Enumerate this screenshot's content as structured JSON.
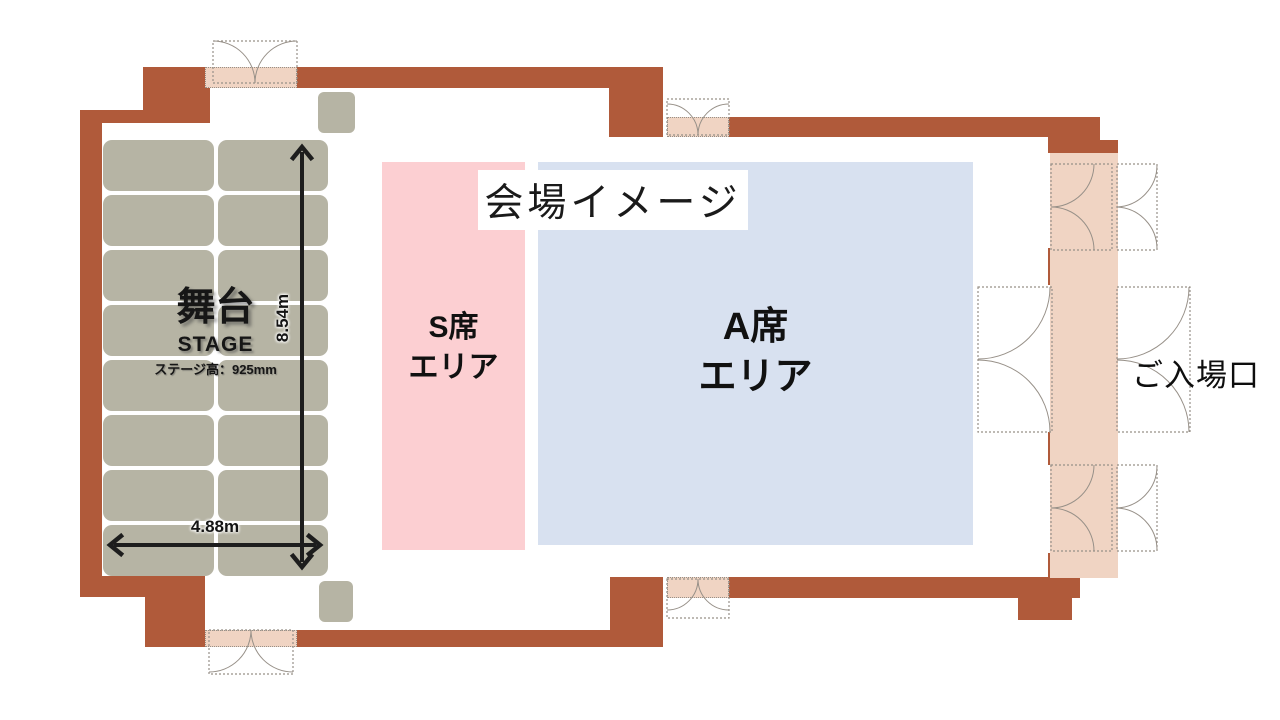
{
  "title": "会場イメージ",
  "stage": {
    "name_ja": "舞台",
    "name_en": "STAGE",
    "height_note": "ステージ高：925mm",
    "width_label": "4.88m",
    "depth_label": "8.54m",
    "grid_rows": 8,
    "grid_cols": 2
  },
  "areas": {
    "s_seat": {
      "line1": "S席",
      "line2": "エリア"
    },
    "a_seat": {
      "line1": "A席",
      "line2": "エリア"
    }
  },
  "entrance_label": "ご入場口",
  "colors": {
    "wall": "#b05a3a",
    "peach": "#f0d4c3",
    "khaki": "#b6b4a4",
    "pink": "#fccfd2",
    "blue": "#d8e1f0",
    "ink": "#1d1d1d",
    "doorline": "#979088"
  }
}
